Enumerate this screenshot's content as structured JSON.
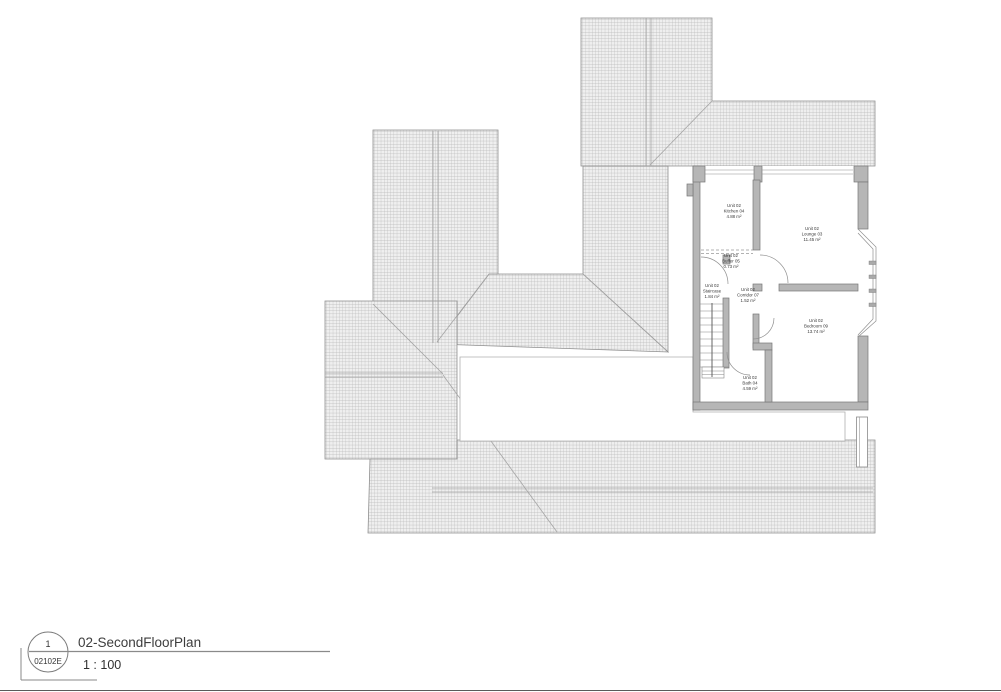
{
  "sheet": {
    "callout": {
      "detail_number": "1",
      "sheet_number": "02102E"
    },
    "view_title": "02-SecondFloorPlan",
    "view_scale": "1 : 100"
  },
  "plan": {
    "unit_name": "Unit 02",
    "rooms": [
      {
        "unit": "Unit 02",
        "name": "Kitchen 04",
        "area": "4.88 m²",
        "x": 734,
        "y": 207
      },
      {
        "unit": "Unit 02",
        "name": "Lounge 03",
        "area": "11.45 m²",
        "x": 812,
        "y": 230
      },
      {
        "unit": "Unit 02",
        "name": "Buffer 05",
        "area": "0.73 m²",
        "x": 731,
        "y": 257
      },
      {
        "unit": "Unit 02",
        "name": "Staircase",
        "area": "1.84 m²",
        "x": 712,
        "y": 287
      },
      {
        "unit": "Unit 02",
        "name": "Corridor 07",
        "area": "1.52 m²",
        "x": 748,
        "y": 291
      },
      {
        "unit": "Unit 02",
        "name": "Bedroom 09",
        "area": "13.74 m²",
        "x": 816,
        "y": 322
      },
      {
        "unit": "Unit 02",
        "name": "Bath 04",
        "area": "4.59 m²",
        "x": 750,
        "y": 379
      }
    ],
    "colors": {
      "roof_hatch_line": "#b8b8b8",
      "roof_hatch_bg": "#efefef",
      "wall_fill": "#b6b6b6",
      "wall_stroke": "#777777",
      "line": "#8f8f8f"
    }
  }
}
